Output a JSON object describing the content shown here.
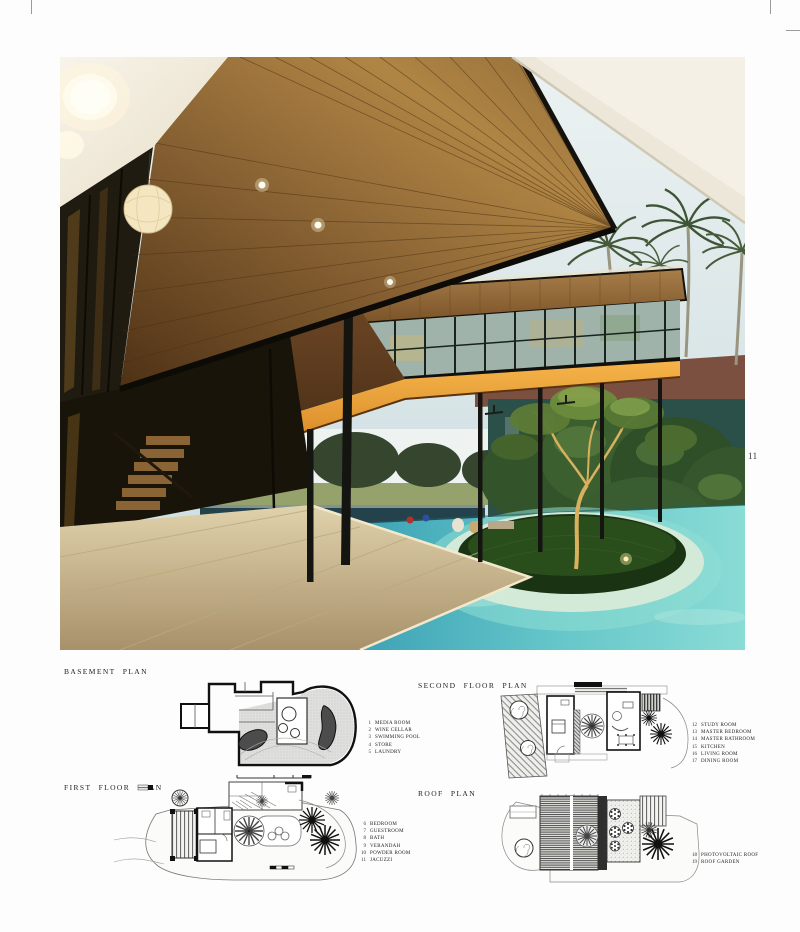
{
  "page": {
    "number": "11"
  },
  "photo": {
    "palette": {
      "sky": "#dbe7e9",
      "wood": "#9a7040",
      "wood-dark": "#4e3115",
      "orange-glow": "#e0922f",
      "pool": "#4db7c6",
      "pool-light": "#8fdfd4",
      "foliage": "#36572e",
      "grass-island": "#1a3312",
      "stone": "#cfc09a",
      "ceiling": "#f4f0e5"
    }
  },
  "plans": {
    "basement": {
      "title": "BASEMENT PLAN",
      "legend": [
        {
          "num": "1",
          "label": "MEDIA ROOM"
        },
        {
          "num": "2",
          "label": "WINE CELLAR"
        },
        {
          "num": "3",
          "label": "SWIMMING POOL"
        },
        {
          "num": "4",
          "label": "STORE"
        },
        {
          "num": "5",
          "label": "LAUNDRY"
        }
      ]
    },
    "first": {
      "title": "FIRST FLOOR PLAN",
      "legend": [
        {
          "num": "6",
          "label": "BEDROOM"
        },
        {
          "num": "7",
          "label": "GUESTROOM"
        },
        {
          "num": "8",
          "label": "BATH"
        },
        {
          "num": "9",
          "label": "VERANDAH"
        },
        {
          "num": "10",
          "label": "POWDER ROOM"
        },
        {
          "num": "11",
          "label": "JACUZZI"
        }
      ]
    },
    "second": {
      "title": "SECOND FLOOR PLAN",
      "legend": [
        {
          "num": "12",
          "label": "STUDY ROOM"
        },
        {
          "num": "13",
          "label": "MASTER BEDROOM"
        },
        {
          "num": "14",
          "label": "MASTER BATHROOM"
        },
        {
          "num": "15",
          "label": "KITCHEN"
        },
        {
          "num": "16",
          "label": "LIVING ROOM"
        },
        {
          "num": "17",
          "label": "DINING ROOM"
        }
      ]
    },
    "roof": {
      "title": "ROOF PLAN",
      "legend": [
        {
          "num": "18",
          "label": "PHOTOVOLTAIC ROOF"
        },
        {
          "num": "19",
          "label": "ROOF GARDEN"
        }
      ]
    }
  }
}
